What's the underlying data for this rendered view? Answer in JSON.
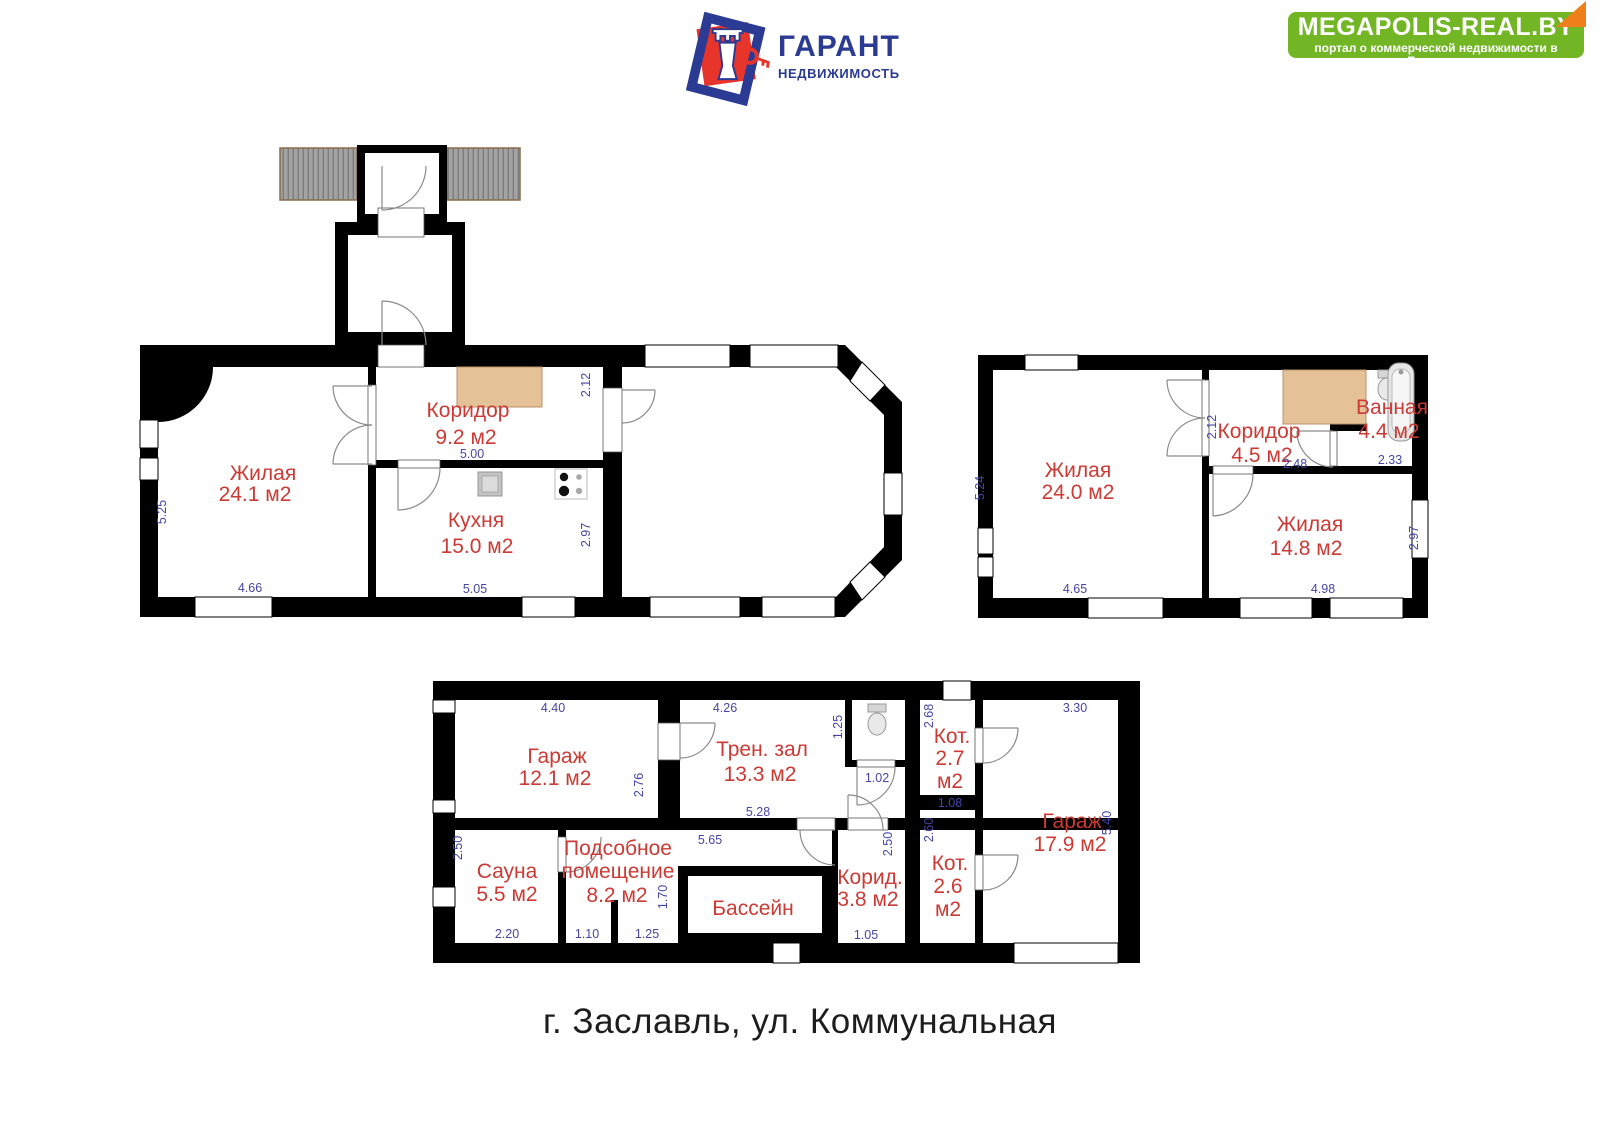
{
  "header": {
    "logo": {
      "title": "ГАРАНТ",
      "subtitle": "НЕДВИЖИМОСТЬ"
    },
    "banner": {
      "title": "MEGAPOLIS-REAL.BY",
      "subtitle": "портал о коммерческой недвижимости в Беларуси"
    }
  },
  "address": "г. Заславль, ул. Коммунальная",
  "colors": {
    "room_label": "#cb3a34",
    "dimension": "#4545a6",
    "banner_green": "#72b626",
    "banner_fold": "#ef7f1b",
    "logo_blue": "#2b3a92",
    "logo_red": "#e8352b",
    "wardrobe_tan": "#e4c197"
  },
  "plan1": {
    "rooms": {
      "living": {
        "name": "Жилая",
        "area": "24.1 м2"
      },
      "corridor": {
        "name": "Коридор",
        "area": "9.2 м2"
      },
      "kitchen": {
        "name": "Кухня",
        "area": "15.0 м2"
      }
    },
    "dims": {
      "living_w": "4.66",
      "living_h": "5.25",
      "corridor_w": "5.00",
      "corridor_h": "2.12",
      "kitchen_w": "5.05",
      "kitchen_h": "2.97"
    }
  },
  "plan2": {
    "rooms": {
      "living1": {
        "name": "Жилая",
        "area": "24.0 м2"
      },
      "corridor": {
        "name": "Коридор",
        "area": "4.5 м2"
      },
      "bath": {
        "name": "Ванная",
        "area": "4.4 м2"
      },
      "living2": {
        "name": "Жилая",
        "area": "14.8 м2"
      }
    },
    "dims": {
      "living1_w": "4.65",
      "living1_h": "5.24",
      "corridor_h": "2.12",
      "corridor_w": "2.48",
      "bath_w": "2.33",
      "living2_w": "4.98",
      "living2_h": "2.97"
    }
  },
  "plan3": {
    "rooms": {
      "garage1": {
        "name": "Гараж",
        "area": "12.1 м2"
      },
      "gym": {
        "name": "Трен. зал",
        "area": "13.3 м2"
      },
      "boiler1": {
        "name": "Кот.",
        "area": "2.7",
        "unit": "м2"
      },
      "garage2": {
        "name": "Гараж",
        "area": "17.9 м2"
      },
      "sauna": {
        "name": "Сауна",
        "area": "5.5 м2"
      },
      "utility": {
        "name_line1": "Подсобное",
        "name_line2": "помещение",
        "area": "8.2 м2"
      },
      "pool": {
        "name": "Бассейн"
      },
      "hall": {
        "name": "Корид.",
        "area": "3.8 м2"
      },
      "boiler2": {
        "name": "Кот.",
        "area": "2.6",
        "unit": "м2"
      }
    },
    "dims": {
      "garage1_w": "4.40",
      "garage1_h": "2.76",
      "gym_w": "4.26",
      "gym_w2": "5.28",
      "wc_h": "1.25",
      "wc_door": "1.02",
      "boiler1_h": "2.68",
      "boiler1_w": "1.08",
      "garage2_w": "3.30",
      "garage2_h": "5.40",
      "sauna_h": "2.50",
      "sauna_w": "2.20",
      "utility_w": "5.65",
      "utility_w1": "1.10",
      "utility_w2": "1.25",
      "pool_h": "1.70",
      "hall_h": "2.50",
      "hall_w": "1.05",
      "boiler2_h": "2.60"
    }
  }
}
